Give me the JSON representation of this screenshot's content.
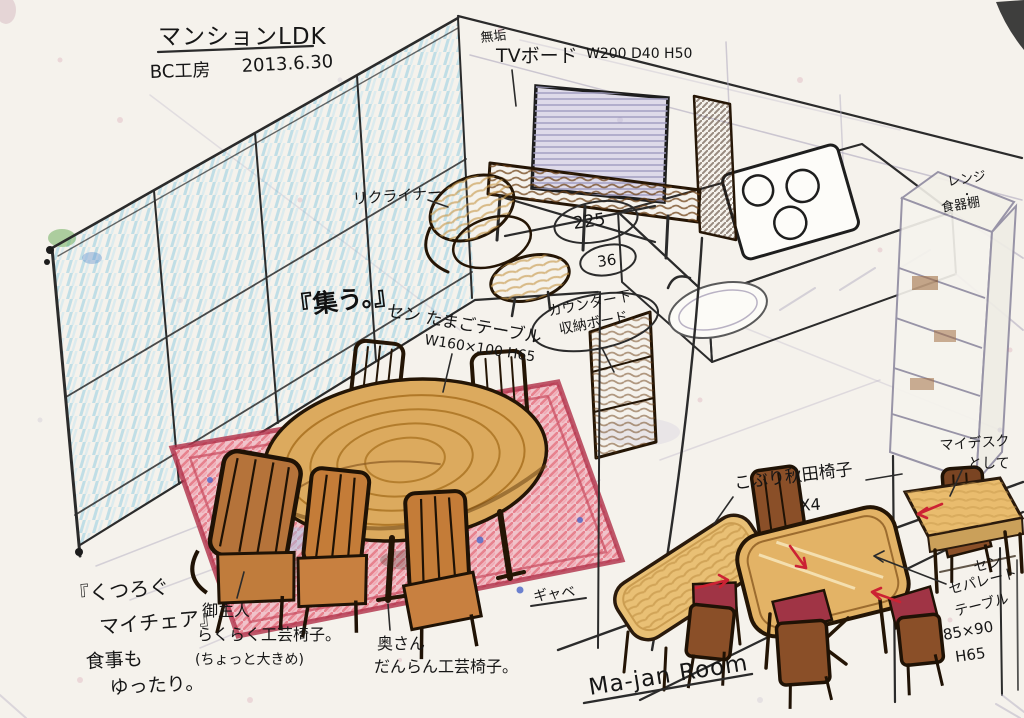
{
  "title": {
    "main": "マンションLDK",
    "studio": "BC工房",
    "date": "2013.6.30"
  },
  "tv": {
    "material": "無垢",
    "name": "TVボード",
    "size": "W200 D40 H50"
  },
  "living": {
    "recliner": "リクライナー",
    "quote": "『集う。』",
    "table_name": "セン たまごテーブル",
    "table_size": "W160×100 H65",
    "rug": "ギャベ",
    "relax_quote_1": "『くつろぐ",
    "relax_quote_2": "マイチェア』",
    "relax_note_1": "食事も",
    "relax_note_2": "ゆったり。",
    "husband_1": "御主人",
    "husband_2": "らくらく工芸椅子。",
    "husband_3": "(ちょっと大きめ)",
    "wife_1": "奥さん",
    "wife_2": "だんらん工芸椅子。"
  },
  "kitchen": {
    "counter_1": "カウンター下",
    "counter_2": "収納ボード",
    "dim_1": "225",
    "dim_2": "36",
    "cabinet_1": "レンジ",
    "cabinet_dot": "・",
    "cabinet_2": "食器棚"
  },
  "majan": {
    "room": "Ma-jan Room",
    "chairs_1": "こぶり秋田椅子",
    "chairs_2": "X4",
    "desk_1": "マイデスク",
    "desk_2": "として",
    "table_1": "セン",
    "table_2": "セパレート",
    "table_3": "テーブル",
    "table_4": "85×90",
    "table_5": "H65"
  },
  "colors": {
    "ink": "#2b2b2b",
    "wood": "#9a6335",
    "tabletop": "#dcaa5e",
    "rug_red": "#d94f63",
    "glass_blue": "#6fc0dd",
    "cushion_red": "#a03445",
    "arrow_red": "#cc2233",
    "paper": "#f5f2ec"
  }
}
